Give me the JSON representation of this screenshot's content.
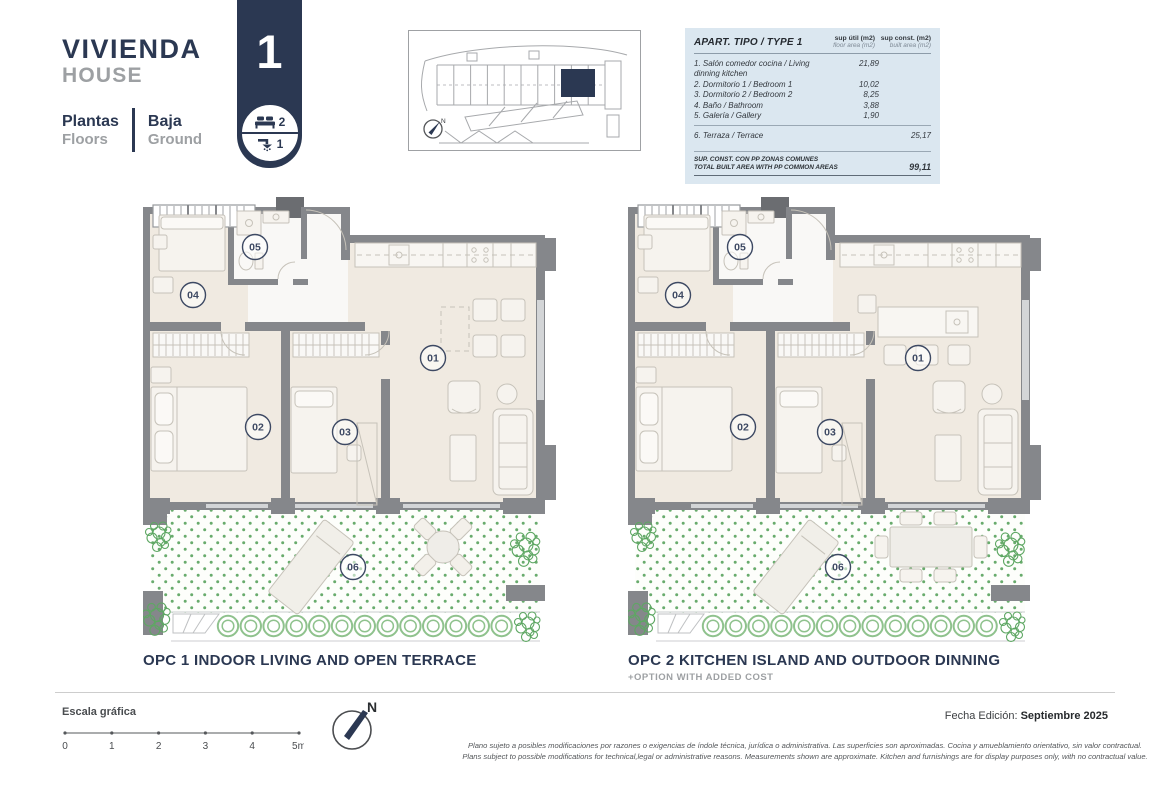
{
  "header": {
    "title_primary": "VIVIENDA",
    "title_secondary": "HOUSE",
    "plantas_label": "Plantas",
    "floors_label": "Floors",
    "baja_label": "Baja",
    "ground_label": "Ground",
    "house_number": "1",
    "bedrooms_count": "2",
    "bathrooms_count": "1"
  },
  "area_table": {
    "title": "APART. TIPO / TYPE 1",
    "col_util": {
      "es": "sup útil (m2)",
      "en": "floor area (m2)"
    },
    "col_const": {
      "es": "sup const. (m2)",
      "en": "built area (m2)"
    },
    "rows": [
      {
        "label": "1. Salón comedor cocina / Living dinning kitchen",
        "util": "21,89",
        "const": ""
      },
      {
        "label": "2. Dormitorio 1 / Bedroom 1",
        "util": "10,02",
        "const": ""
      },
      {
        "label": "3. Dormitorio 2 / Bedroom 2",
        "util": "8,25",
        "const": ""
      },
      {
        "label": "4. Baño / Bathroom",
        "util": "3,88",
        "const": ""
      },
      {
        "label": "5. Galería / Gallery",
        "util": "1,90",
        "const": ""
      }
    ],
    "terrace_row": {
      "label": "6. Terraza / Terrace",
      "util": "",
      "const": "25,17"
    },
    "total": {
      "label_es": "SUP. CONST. CON PP ZONAS COMUNES",
      "label_en": "TOTAL BUILT AREA WITH PP COMMON AREAS",
      "value": "99,11"
    }
  },
  "plans": [
    {
      "caption": "OPC 1 INDOOR LIVING AND OPEN TERRACE",
      "note": "",
      "variant": "opc1",
      "room_labels": [
        "01",
        "02",
        "03",
        "04",
        "05",
        "06"
      ]
    },
    {
      "caption": "OPC 2 KITCHEN ISLAND AND OUTDOOR DINNING",
      "note": "+OPTION WITH ADDED COST",
      "variant": "opc2",
      "room_labels": [
        "01",
        "02",
        "03",
        "04",
        "05",
        "06"
      ]
    }
  ],
  "footer": {
    "scale_label": "Escala gráfica",
    "scale_ticks": [
      "0",
      "1",
      "2",
      "3",
      "4",
      "5m"
    ],
    "north_label": "N",
    "edition_label": "Fecha Edición:",
    "edition_value": "Septiembre 2025",
    "disclaimer_line1": "Plano sujeto a posibles modificaciones por razones o exigencias de índole técnica,  jurídica o administrativa. Las superficies son aproximadas. Cocina y amueblamiento orientativo, sin valor contractual.",
    "disclaimer_line2": "Plans subject to possible modifications for technical,legal or administrative reasons. Measurements shown are approximate. Kitchen and furnishings are for display purposes only, with no contractual value."
  },
  "colors": {
    "navy": "#2b3852",
    "gray_text": "#9da0a3",
    "table_bg": "#dbe7f0",
    "wall_gray": "#85878b",
    "floor_beige": "#f0eae1",
    "terrace_green": "#68ab6c"
  }
}
